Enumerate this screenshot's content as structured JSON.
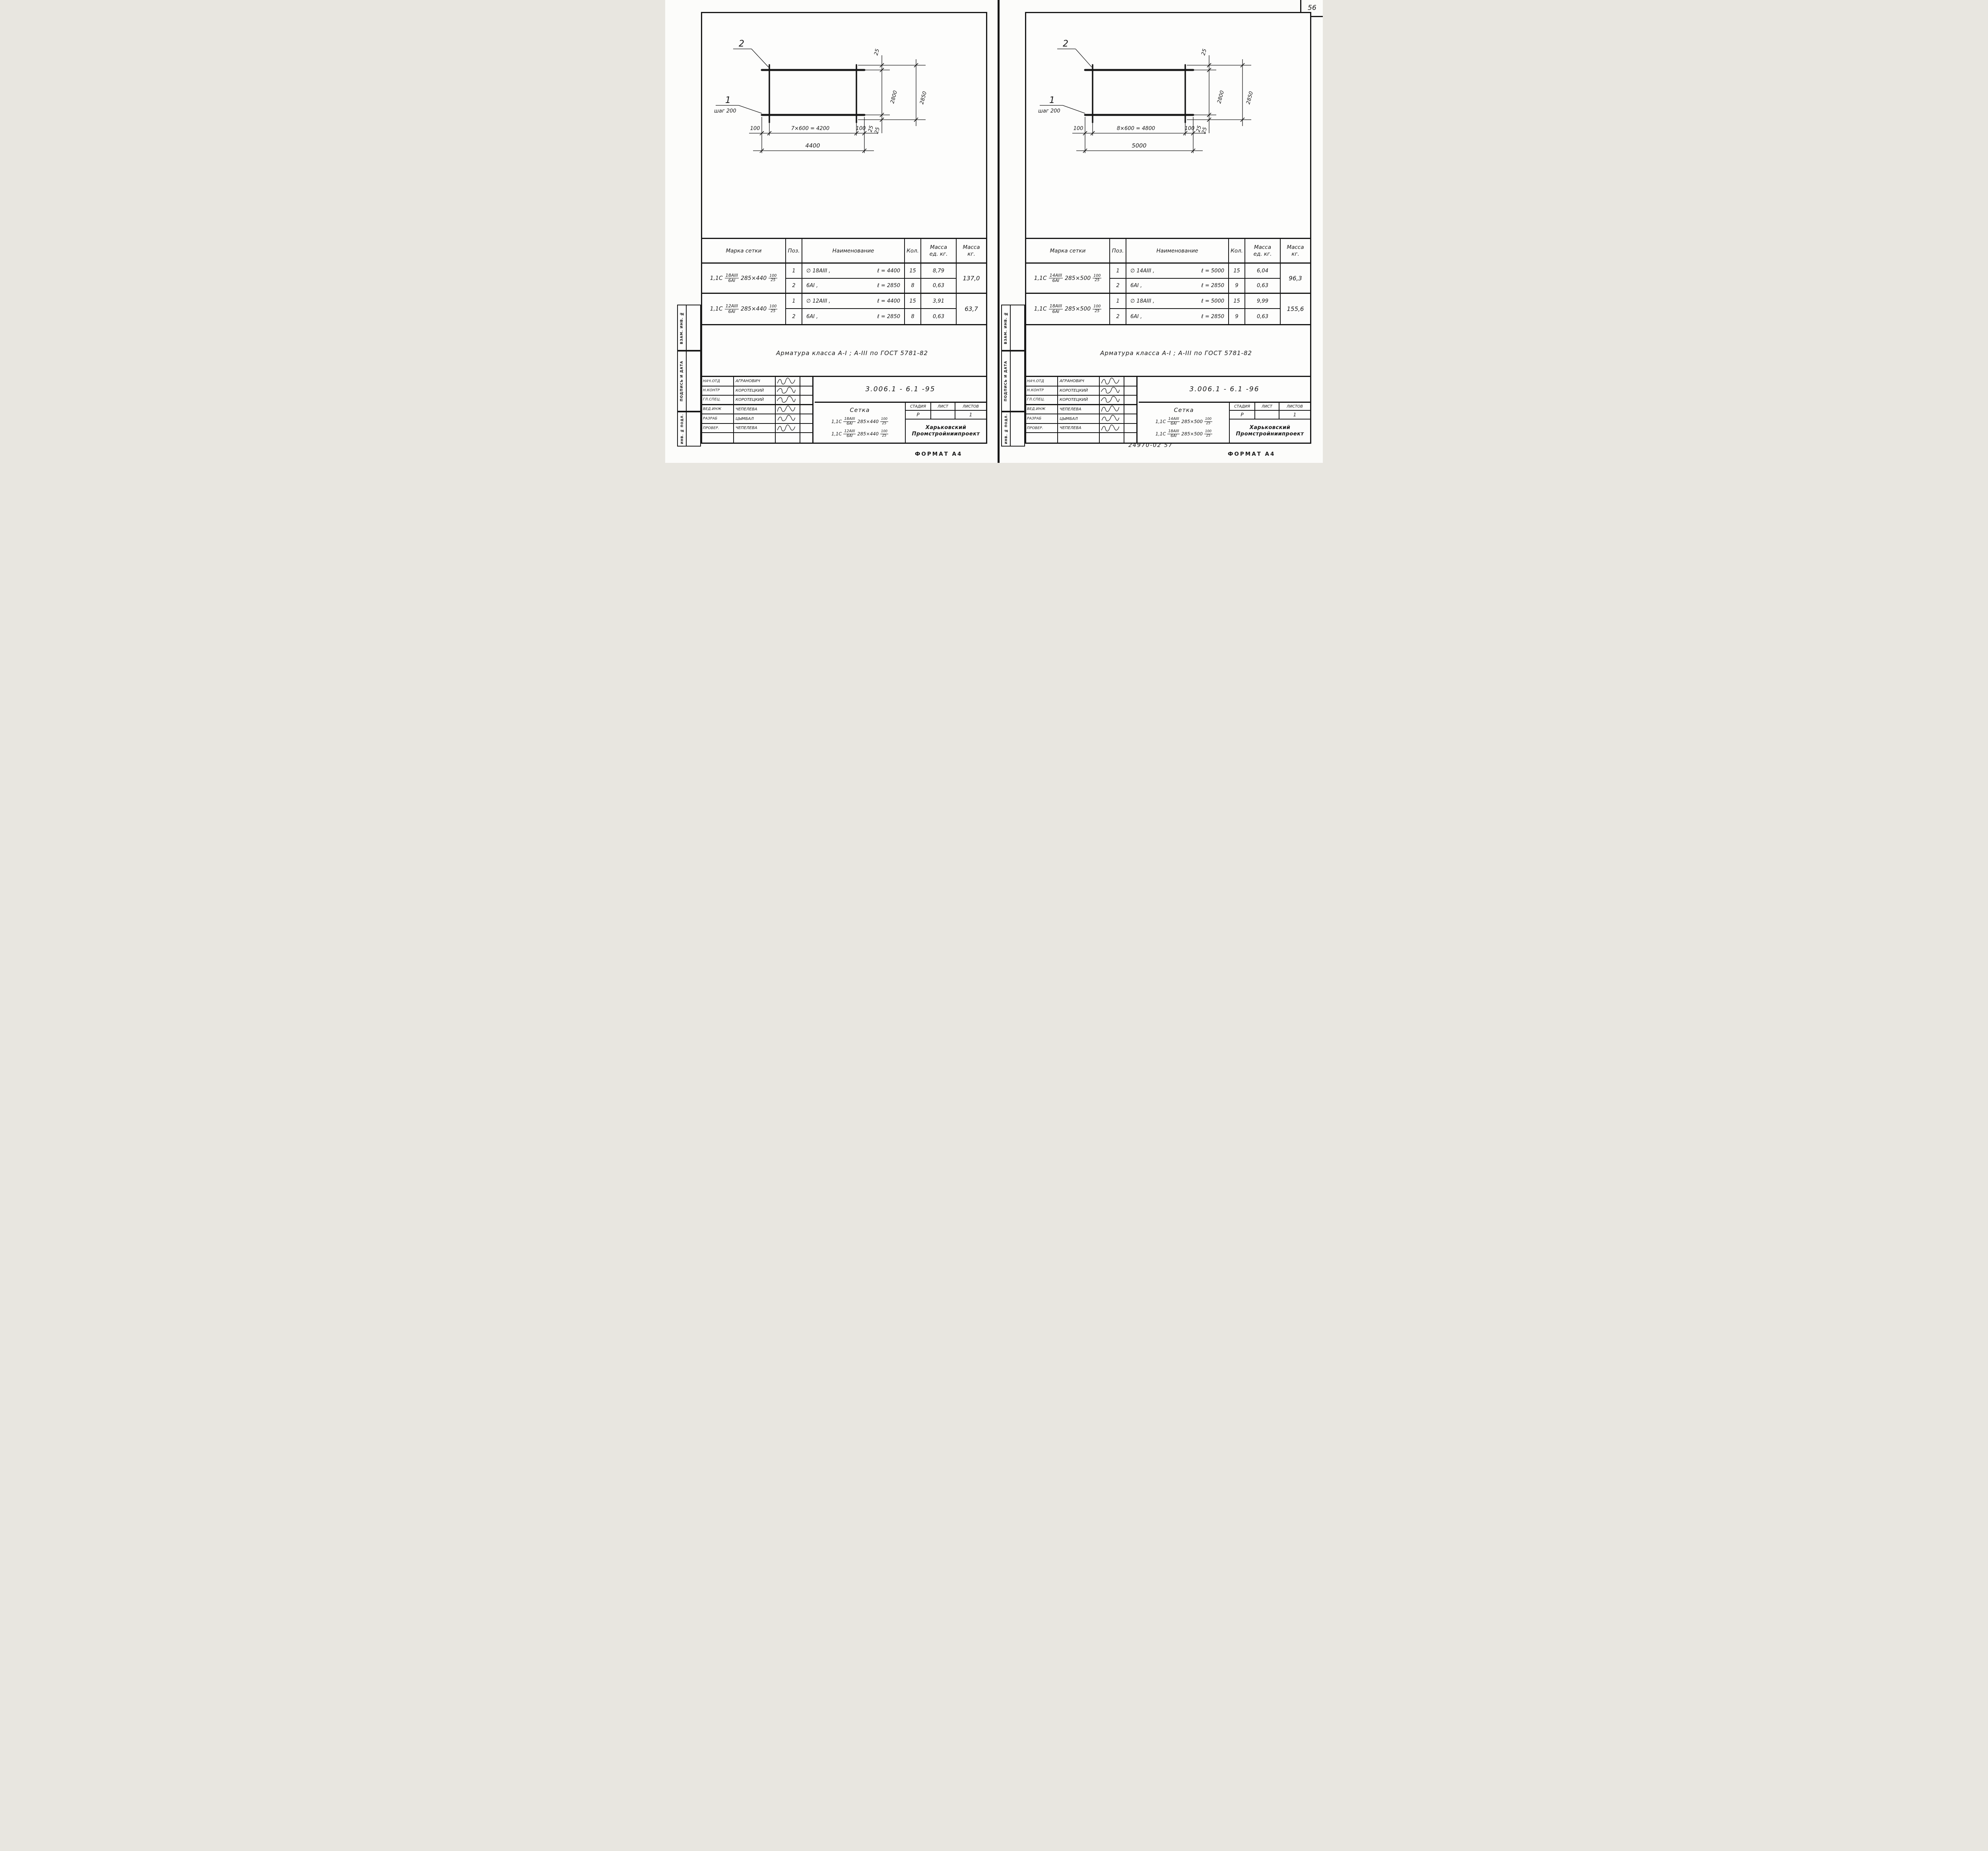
{
  "page": {
    "number": "56",
    "format_label_left": "ФОРМАТ А4",
    "format_label_right": "ФОРМАТ А4",
    "stamp_code": "24970-02    57"
  },
  "sidebar": {
    "vzam": "ВЗАМ. ИНВ. №",
    "podpis": "ПОДПИСЬ И ДАТА",
    "inv": "ИНВ. № ПОДЛ."
  },
  "table_header": {
    "mark": "Марка сетки",
    "pos": "Поз.",
    "name": "Наименование",
    "qty": "Кол.",
    "mass_unit_1": "Масса",
    "mass_unit_2": "ед. кг.",
    "mass_1": "Масса",
    "mass_2": "кг."
  },
  "note": "Арматура класса  А-I ; А-III  по ГОСТ 5781-82",
  "personnel": {
    "rows": [
      {
        "role": "НАЧ.ОТД",
        "name": "АГРАНОВИЧ"
      },
      {
        "role": "Н.КОНТР",
        "name": "КОРОТЕЦКИЙ"
      },
      {
        "role": "ГЛ.СПЕЦ.",
        "name": "КОРОТЕЦКИЙ"
      },
      {
        "role": "ВЕД.ИНЖ",
        "name": "ЧЕПЕЛЕВА"
      },
      {
        "role": "РАЗРАБ",
        "name": "ЦЫМБАЛ"
      },
      {
        "role": "ПРОВЕР.",
        "name": "ЧЕПЕЛЕВА"
      }
    ]
  },
  "stamp": {
    "stage_label": "СТАДИЯ",
    "sheet_label": "ЛИСТ",
    "sheets_label": "ЛИСТОВ",
    "stage": "Р",
    "sheet": "",
    "sheets_count": "1",
    "org_line1": "Харьковский",
    "org_line2": "Промстройниипроект",
    "title": "Сетка"
  },
  "diagram_common": {
    "label_top": "2",
    "label_bottom": "1",
    "step_note": "шаг 200",
    "dim_25": "25",
    "dim_2800": "2800",
    "dim_2850": "2850",
    "dim_100": "100"
  },
  "sheets": [
    {
      "doc_number": "3.006.1 - 6.1  -95",
      "diagram": {
        "spacing": "7×600 = 4200",
        "total": "4400"
      },
      "marks": [
        {
          "prefix": "1,1С",
          "num": "18АIII",
          "den": "6АI",
          "size": "285×440",
          "sub_num": "100",
          "sub_den": "25",
          "rows": [
            {
              "pos": "1",
              "name": "∅ 18АIII ,",
              "len": "ℓ = 4400",
              "qty": "15",
              "unit": "8,79"
            },
            {
              "pos": "2",
              "name": "6АI ,",
              "len": "ℓ = 2850",
              "qty": "8",
              "unit": "0,63"
            }
          ],
          "total": "137,0"
        },
        {
          "prefix": "1,1С",
          "num": "12АIII",
          "den": "6АI",
          "size": "285×440",
          "sub_num": "100",
          "sub_den": "25",
          "rows": [
            {
              "pos": "1",
              "name": "∅ 12АIII ,",
              "len": "ℓ = 4400",
              "qty": "15",
              "unit": "3,91"
            },
            {
              "pos": "2",
              "name": "6АI ,",
              "len": "ℓ = 2850",
              "qty": "8",
              "unit": "0,63"
            }
          ],
          "total": "63,7"
        }
      ]
    },
    {
      "doc_number": "3.006.1 - 6.1  -96",
      "diagram": {
        "spacing": "8×600 = 4800",
        "total": "5000"
      },
      "marks": [
        {
          "prefix": "1,1С",
          "num": "14АIII",
          "den": "6АI",
          "size": "285×500",
          "sub_num": "100",
          "sub_den": "25",
          "rows": [
            {
              "pos": "1",
              "name": "∅ 14АIII ,",
              "len": "ℓ = 5000",
              "qty": "15",
              "unit": "6,04"
            },
            {
              "pos": "2",
              "name": "6АI ,",
              "len": "ℓ = 2850",
              "qty": "9",
              "unit": "0,63"
            }
          ],
          "total": "96,3"
        },
        {
          "prefix": "1,1С",
          "num": "18АIII",
          "den": "6АI",
          "size": "285×500",
          "sub_num": "100",
          "sub_den": "25",
          "rows": [
            {
              "pos": "1",
              "name": "∅ 18АIII ,",
              "len": "ℓ = 5000",
              "qty": "15",
              "unit": "9,99"
            },
            {
              "pos": "2",
              "name": "6АI ,",
              "len": "ℓ = 2850",
              "qty": "9",
              "unit": "0,63"
            }
          ],
          "total": "155,6"
        }
      ]
    }
  ]
}
